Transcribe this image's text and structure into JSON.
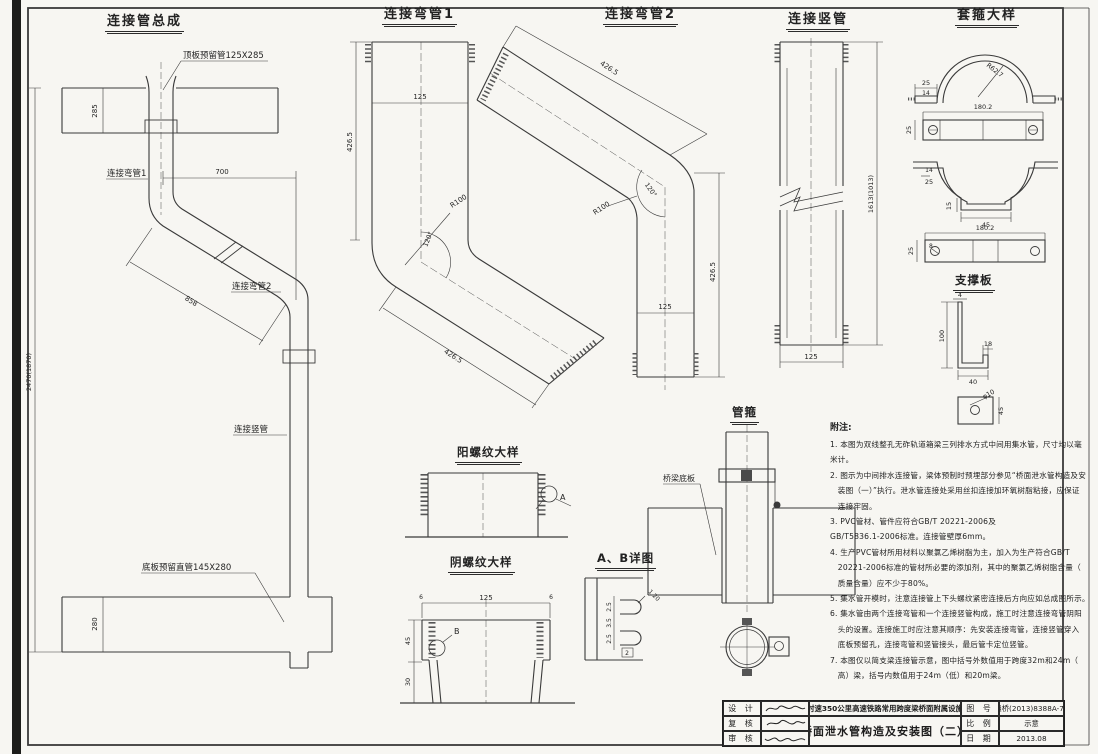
{
  "assembly": {
    "title": "连接管总成",
    "labels": {
      "top_pipe": "顶板预留管125X285",
      "bend1": "连接弯管1",
      "bend2": "连接弯管2",
      "vpipe": "连接竖管",
      "bottom_pipe": "底板预留直管145X280"
    },
    "dims": {
      "slab_top_h": "285",
      "offset_h": "700",
      "diag_len": "858",
      "total_h": "2470(1870)",
      "slab_bot_h": "280"
    }
  },
  "bend1": {
    "title": "连接弯管1",
    "dims": {
      "width": "125",
      "height": "426.5",
      "radius": "R100",
      "angle": "120°",
      "diag": "426.5"
    }
  },
  "bend2": {
    "title": "连接弯管2",
    "dims": {
      "diag": "426.5",
      "angle": "120°",
      "radius": "R100",
      "height": "426.5",
      "width": "125"
    }
  },
  "vpipe": {
    "title": "连接竖管",
    "dims": {
      "height": "1613(1013)",
      "width": "125"
    }
  },
  "collar": {
    "title": "套箍大样",
    "dims": {
      "d25_top": "25",
      "d14_top": "14",
      "radius": "R62.7",
      "len_top": "180.2",
      "d25_bar1": "25",
      "d14_u": "14",
      "d25_u": "25",
      "d15": "15",
      "d45": "45",
      "len_bot": "180.2",
      "d25_bar2": "25",
      "d8": "8"
    }
  },
  "support": {
    "title": "支撑板",
    "dims": {
      "t4": "4",
      "h100": "100",
      "w18": "18",
      "w40": "40",
      "hole": "φ10",
      "sq45": "45"
    }
  },
  "male_thread": {
    "title": "阳螺纹大样",
    "callout": "A"
  },
  "female_thread": {
    "title": "阴螺纹大样",
    "dims": {
      "w125": "125",
      "e6l": "6",
      "e6r": "6",
      "h45": "45",
      "h30": "30"
    },
    "callout": "B"
  },
  "detail_ab": {
    "title": "A、B详图",
    "dims": {
      "p1": "2.5",
      "p2": "3.5",
      "p3": "2.5",
      "b2": "2",
      "r": "1.20"
    }
  },
  "clamp": {
    "title": "管箍",
    "slab_label": "桥梁底板"
  },
  "notes": {
    "heading": "附注:",
    "lines": [
      "1. 本图为双线整孔无砟轨道箱梁三列排水方式中间用集水管，尺寸均以毫",
      "米计。",
      "2. 图示为中间排水连接管，梁体预制时预埋部分参见“桥面泄水管构造及安",
      "　装图（一）”执行。泄水管连接处采用丝扣连接加环氧树脂粘接，应保证",
      "　连接牢固。",
      "3. PVC管材、管件应符合GB/T 20221-2006及",
      "GB/T5836.1-2006标准。连接管壁厚6mm。",
      "4. 生产PVC管材所用材料以聚氯乙烯树脂为主，加入为生产符合GB/T",
      "　20221-2006标准的管材所必要的添加剂，其中的聚氯乙烯树脂含量（",
      "　质量含量）应不少于80%。",
      "5. 集水管开模时，注意连接管上下头螺纹紧密连接后方向应如总成图所示。",
      "6. 集水管由两个连接弯管和一个连接竖管构成，施工时注意连接弯管阴阳",
      "　头的设置。连接施工时应注意其顺序：先安装连接弯管，连接竖管穿入",
      "　底板预留孔，连接弯管和竖管接头，最后管卡定位竖管。",
      "7. 本图仅以简支梁连接管示意，图中括号外数值用于跨度32m和24m（",
      "　高）梁，括号内数值用于24m（低）和20m梁。"
    ]
  },
  "titleblock": {
    "rows_left": [
      {
        "label": "设  计"
      },
      {
        "label": "复  核"
      },
      {
        "label": "审  核"
      }
    ],
    "project": "时速350公里高速铁路常用跨度梁桥面附属设施",
    "sheet_title": "桥面泄水管构造及安装图（二）",
    "fields": [
      {
        "label": "图  号",
        "value": "通桥(2013)8388A-73"
      },
      {
        "label": "比  例",
        "value": "示意"
      },
      {
        "label": "日  期",
        "value": "2013.08"
      }
    ]
  }
}
